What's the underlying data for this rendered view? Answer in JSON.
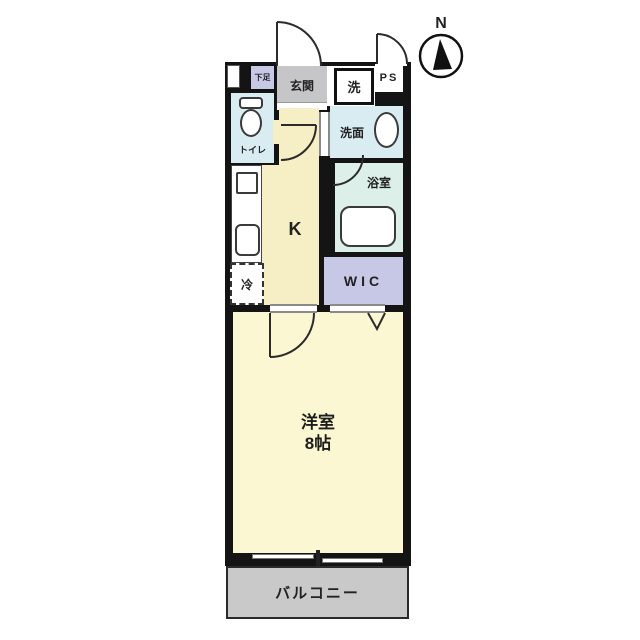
{
  "compass": {
    "north_label": "N"
  },
  "labels": {
    "shoe_storage": "下足",
    "entrance": "玄関",
    "washer": "洗",
    "pipe_space": "PS",
    "toilet": "トイレ",
    "washroom": "洗面",
    "bathroom": "浴室",
    "kitchen": "K",
    "refrigerator": "冷",
    "walk_in_closet": "WIC",
    "western_room_name": "洋室",
    "western_room_size": "8帖",
    "balcony": "バルコニー"
  },
  "colors": {
    "wall": "#141414",
    "kitchen_floor": "#f6efc6",
    "bedroom_floor": "#faf7d2",
    "wet_area_floor": "#d8ecf2",
    "bathroom_floor": "#dcf0e9",
    "closet_floor": "#c7c7e6",
    "entrance_floor": "#c6c6c9",
    "balcony_floor": "#c9c9c9"
  }
}
